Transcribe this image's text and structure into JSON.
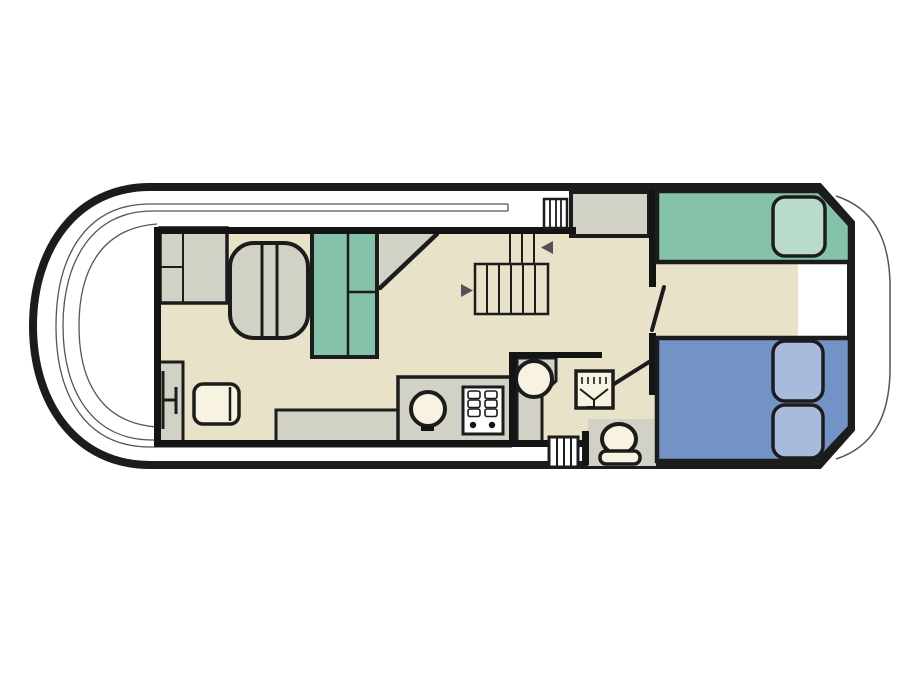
{
  "palette": {
    "hull_outline": "#1c1c1c",
    "wall": "#141414",
    "floor_beige": "#e7e2c8",
    "furniture_gray": "#d2d1c6",
    "upholstery_teal": "#84c2aa",
    "pillow_teal": "#b9dbca",
    "bed_blue": "#7392c5",
    "pillow_blue": "#a9bbdd",
    "fixture_cream": "#f7f3e0",
    "stove_white": "#ffffff",
    "deck_white": "#ffffff",
    "arrow": "#55505c",
    "thin_line": "#555555"
  }
}
